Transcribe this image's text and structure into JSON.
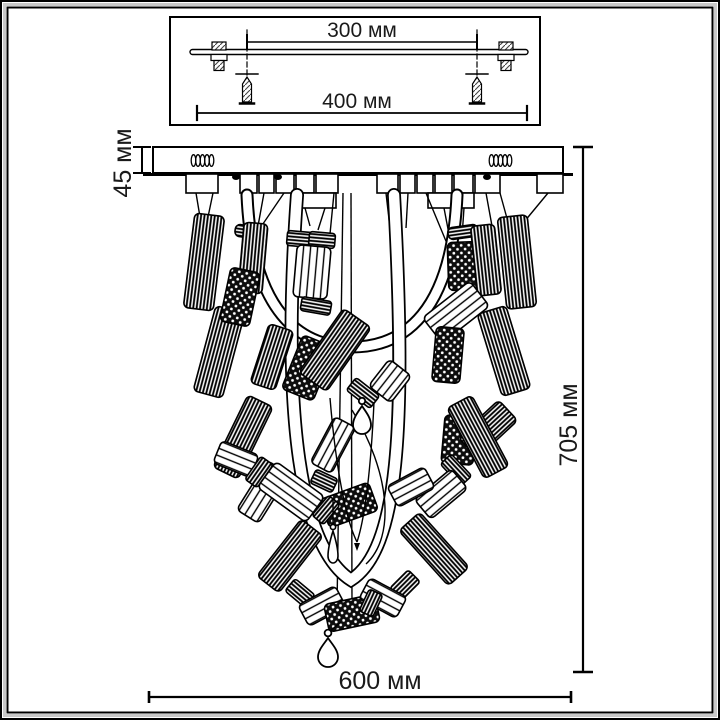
{
  "drawing": {
    "kind": "chandelier dimensional drawing",
    "labels": {
      "top_inner_width": "300 мм",
      "top_outer_width": "400 мм",
      "canopy_height": "45 мм",
      "fixture_height": "705 мм",
      "fixture_width": "600 мм"
    },
    "colors": {
      "ink": "#000000",
      "frame_gray": "#c9c9c9",
      "paper": "#ffffff"
    }
  }
}
